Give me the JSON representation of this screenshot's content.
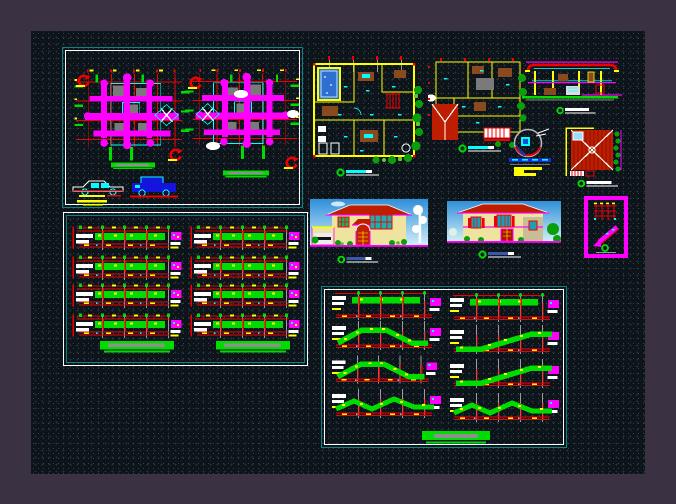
{
  "window": {
    "name": "cad-model-space",
    "description": "Dark CAD model-space viewport showing a residential project drawing set (plans, elevations, sections, structural sheets)"
  },
  "colors": {
    "bg_outer": "#3a3242",
    "canvas_bg": "#0c141a",
    "teal": "#0e8282",
    "magenta": "#ff00ff",
    "red": "#f20000",
    "green": "#00dc00",
    "yellow": "#ffff00",
    "cyan": "#00ffff",
    "gray": "#9c9c9c",
    "blue": "#1414dc",
    "roof": "#bf1d00",
    "cream": "#efe3a0",
    "brown": "#8a4a1e",
    "sky_top": "#2f8fd9",
    "sky_bottom": "#cfeef8"
  },
  "sheets": [
    {
      "id": "framing-plans",
      "label": "structural framing plans sheet",
      "border": "teal outer, white inner",
      "drawings": [
        "framing-plan-level-1",
        "framing-plan-level-2",
        "revision-clouds",
        "foundation-pads",
        "car-outline-detail",
        "car-solid-detail",
        "rotation-arrows"
      ]
    },
    {
      "id": "beam-elevations",
      "label": "beam elevations sheet",
      "border": "white outer, teal inner",
      "columns": 2,
      "rows_per_column": 4,
      "row_elements": [
        "grid-chord",
        "green-beam",
        "detail-callout",
        "footing-pad"
      ]
    },
    {
      "id": "stair-sections",
      "label": "stair sections sheet",
      "border": "teal outer, white inner",
      "columns": 2,
      "rows_per_column": 4,
      "row_variants": [
        "landing",
        "flight-peak",
        "flight-rise",
        "flight-zigzag"
      ],
      "footer": "foundation-bar"
    }
  ],
  "floating_drawings": [
    {
      "id": "furniture-plan-ground",
      "label": "ground floor furniture plan with pool and garden"
    },
    {
      "id": "furniture-plan-upper",
      "label": "upper floor furniture plan with partial roof"
    },
    {
      "id": "building-section",
      "label": "longitudinal building section"
    },
    {
      "id": "column-detail",
      "label": "circular connection detail with leader arrow"
    },
    {
      "id": "roof-plan",
      "label": "hip roof plan with skylight and garden edge"
    },
    {
      "id": "front-elevation-render",
      "label": "rendered front elevation with garage and palms"
    },
    {
      "id": "side-elevation-render",
      "label": "rendered side elevation with trees"
    },
    {
      "id": "stair-detail-callout",
      "label": "stair detail highlighted in magenta frame"
    }
  ],
  "scale_markers": {
    "count": 6,
    "style": "green donut with horizontal scale bar"
  },
  "annotations": {
    "note": "dimension and axis micro-text rendered as yellow/white tick blocks; not legible at source resolution"
  }
}
